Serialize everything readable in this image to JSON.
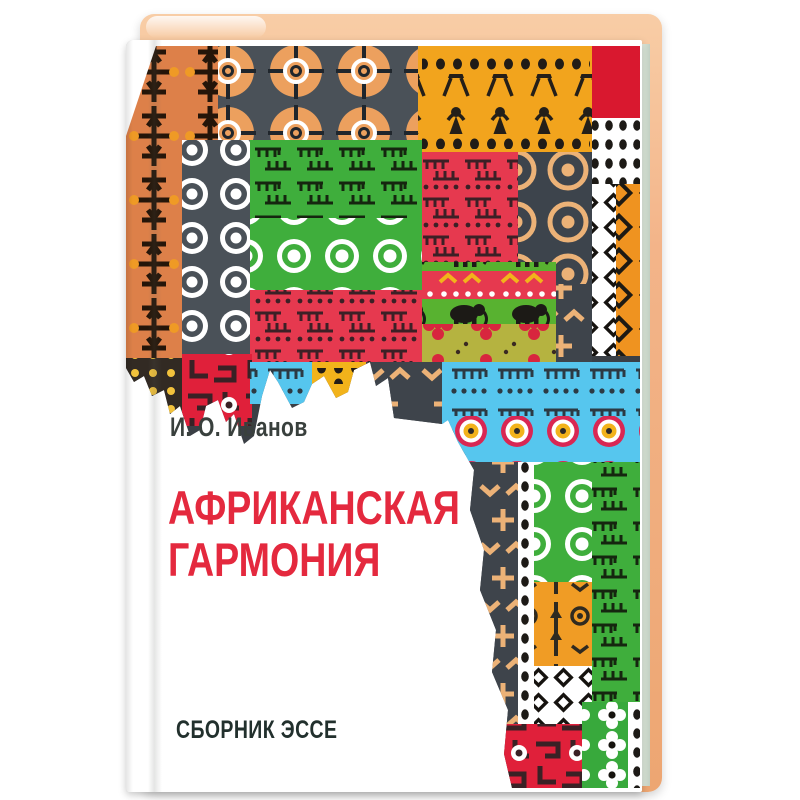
{
  "book": {
    "author": "И. О. Иванов",
    "title_line1": "Африканская",
    "title_line2": "гармония",
    "subtitle": "Сборник эссе",
    "title_color": "#e4293e",
    "text_color": "#39403d",
    "subtitle_color": "#22302d",
    "cover_color": "#ffffff",
    "board_color": "#f3b489"
  },
  "artwork": {
    "name": "africa-map-textile-collage",
    "shape": "continent-of-africa",
    "motifs": [
      "spoked-circles",
      "walking-figures",
      "elephants",
      "comb-rows",
      "concentric-rings",
      "diamond-knot-chains",
      "clover-flowers",
      "dotted-ladders",
      "arrows-chevrons",
      "maze-lines",
      "dot-grids"
    ],
    "palette": {
      "orange": "#ef9320",
      "golden_yellow": "#f2a41d",
      "terracotta": "#dd8049",
      "tan": "#ecb277",
      "crimson": "#e6394f",
      "red": "#e0203a",
      "green": "#3fae3c",
      "leaf_green": "#58b230",
      "khaki": "#b5b340",
      "sky_blue": "#56c6ee",
      "charcoal": "#3e444b",
      "slate": "#4a5158",
      "black": "#1d1a16",
      "white": "#ffffff",
      "magenta": "#d92753"
    }
  }
}
